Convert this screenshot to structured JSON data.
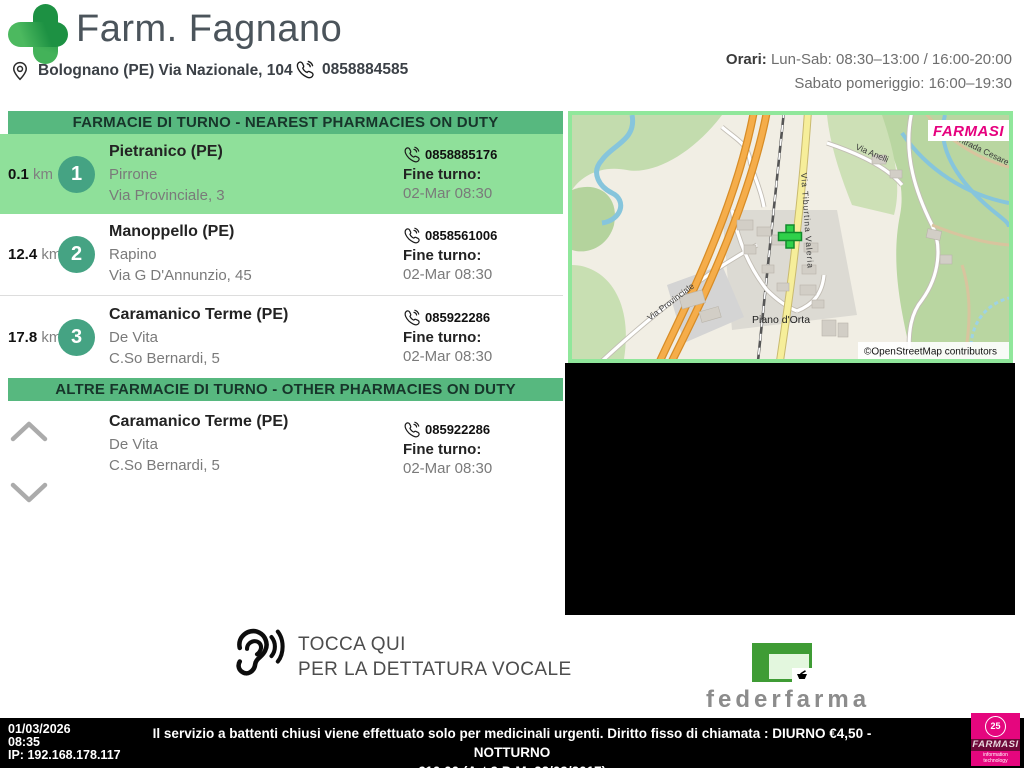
{
  "header": {
    "pharmacy_name": "Farm. Fagnano",
    "address": "Bolognano (PE) Via Nazionale, 104",
    "phone": "0858884585",
    "hours_label": "Orari:",
    "hours_line1": "Lun-Sab: 08:30–13:00 / 16:00-20:00",
    "hours_line2": "Sabato pomeriggio: 16:00–19:30"
  },
  "nearest_section": {
    "title": "FARMACIE DI TURNO - NEAREST PHARMACIES ON DUTY",
    "items": [
      {
        "distance": "0.1",
        "unit": "km",
        "rank": "1",
        "city": "Pietranico (PE)",
        "name": "Pirrone",
        "address": "Via Provinciale, 3",
        "phone": "0858885176",
        "fine_turno_label": "Fine turno:",
        "fine_turno": "02-Mar 08:30"
      },
      {
        "distance": "12.4",
        "unit": "km",
        "rank": "2",
        "city": "Manoppello (PE)",
        "name": "Rapino",
        "address": "Via G D'Annunzio, 45",
        "phone": "0858561006",
        "fine_turno_label": "Fine turno:",
        "fine_turno": "02-Mar 08:30"
      },
      {
        "distance": "17.8",
        "unit": "km",
        "rank": "3",
        "city": "Caramanico Terme (PE)",
        "name": "De Vita",
        "address": "C.So Bernardi, 5",
        "phone": "085922286",
        "fine_turno_label": "Fine turno:",
        "fine_turno": "02-Mar 08:30"
      }
    ]
  },
  "other_section": {
    "title": "ALTRE FARMACIE DI TURNO - OTHER PHARMACIES ON DUTY",
    "items": [
      {
        "city": "Caramanico Terme (PE)",
        "name": "De Vita",
        "address": "C.So Bernardi, 5",
        "phone": "085922286",
        "fine_turno_label": "Fine turno:",
        "fine_turno": "02-Mar 08:30"
      }
    ]
  },
  "map": {
    "overlay_brand": "FARMASI",
    "attribution": "©OpenStreetMap contributors",
    "labels": {
      "main_road": "Via Tiburtina Valeria",
      "road_anelli": "Via Anelli",
      "road_contrada": "Contrada Cesare",
      "road_provinciale": "Via Provinciale",
      "place": "Piano d'Orta"
    }
  },
  "voice": {
    "line1": "TOCCA QUI",
    "line2": "PER LA DETTATURA VOCALE"
  },
  "federfarma": {
    "label": "federfarma"
  },
  "footer": {
    "date": "01/03/2026",
    "time": "08:35",
    "ip": "IP: 192.168.178.117",
    "notice_line1": "Il servizio a battenti chiusi viene effettuato solo per medicinali urgenti. Diritto fisso di chiamata : DIURNO €4,50 - NOTTURNO",
    "notice_line2": "€10,00 (Art.9 D.M. 22/09/2017)",
    "logo": {
      "emblem": "25",
      "brand": "FARMASI",
      "tagline": "information technology"
    }
  },
  "colors": {
    "section_bar_green": "#57b87f",
    "highlight_green": "#8fe09a",
    "badge_green": "#45a383",
    "map_frame_green": "#90e79b",
    "brand_magenta": "#e5067e",
    "federfarma_green": "#3f9c35",
    "footer_bg": "#000000"
  }
}
